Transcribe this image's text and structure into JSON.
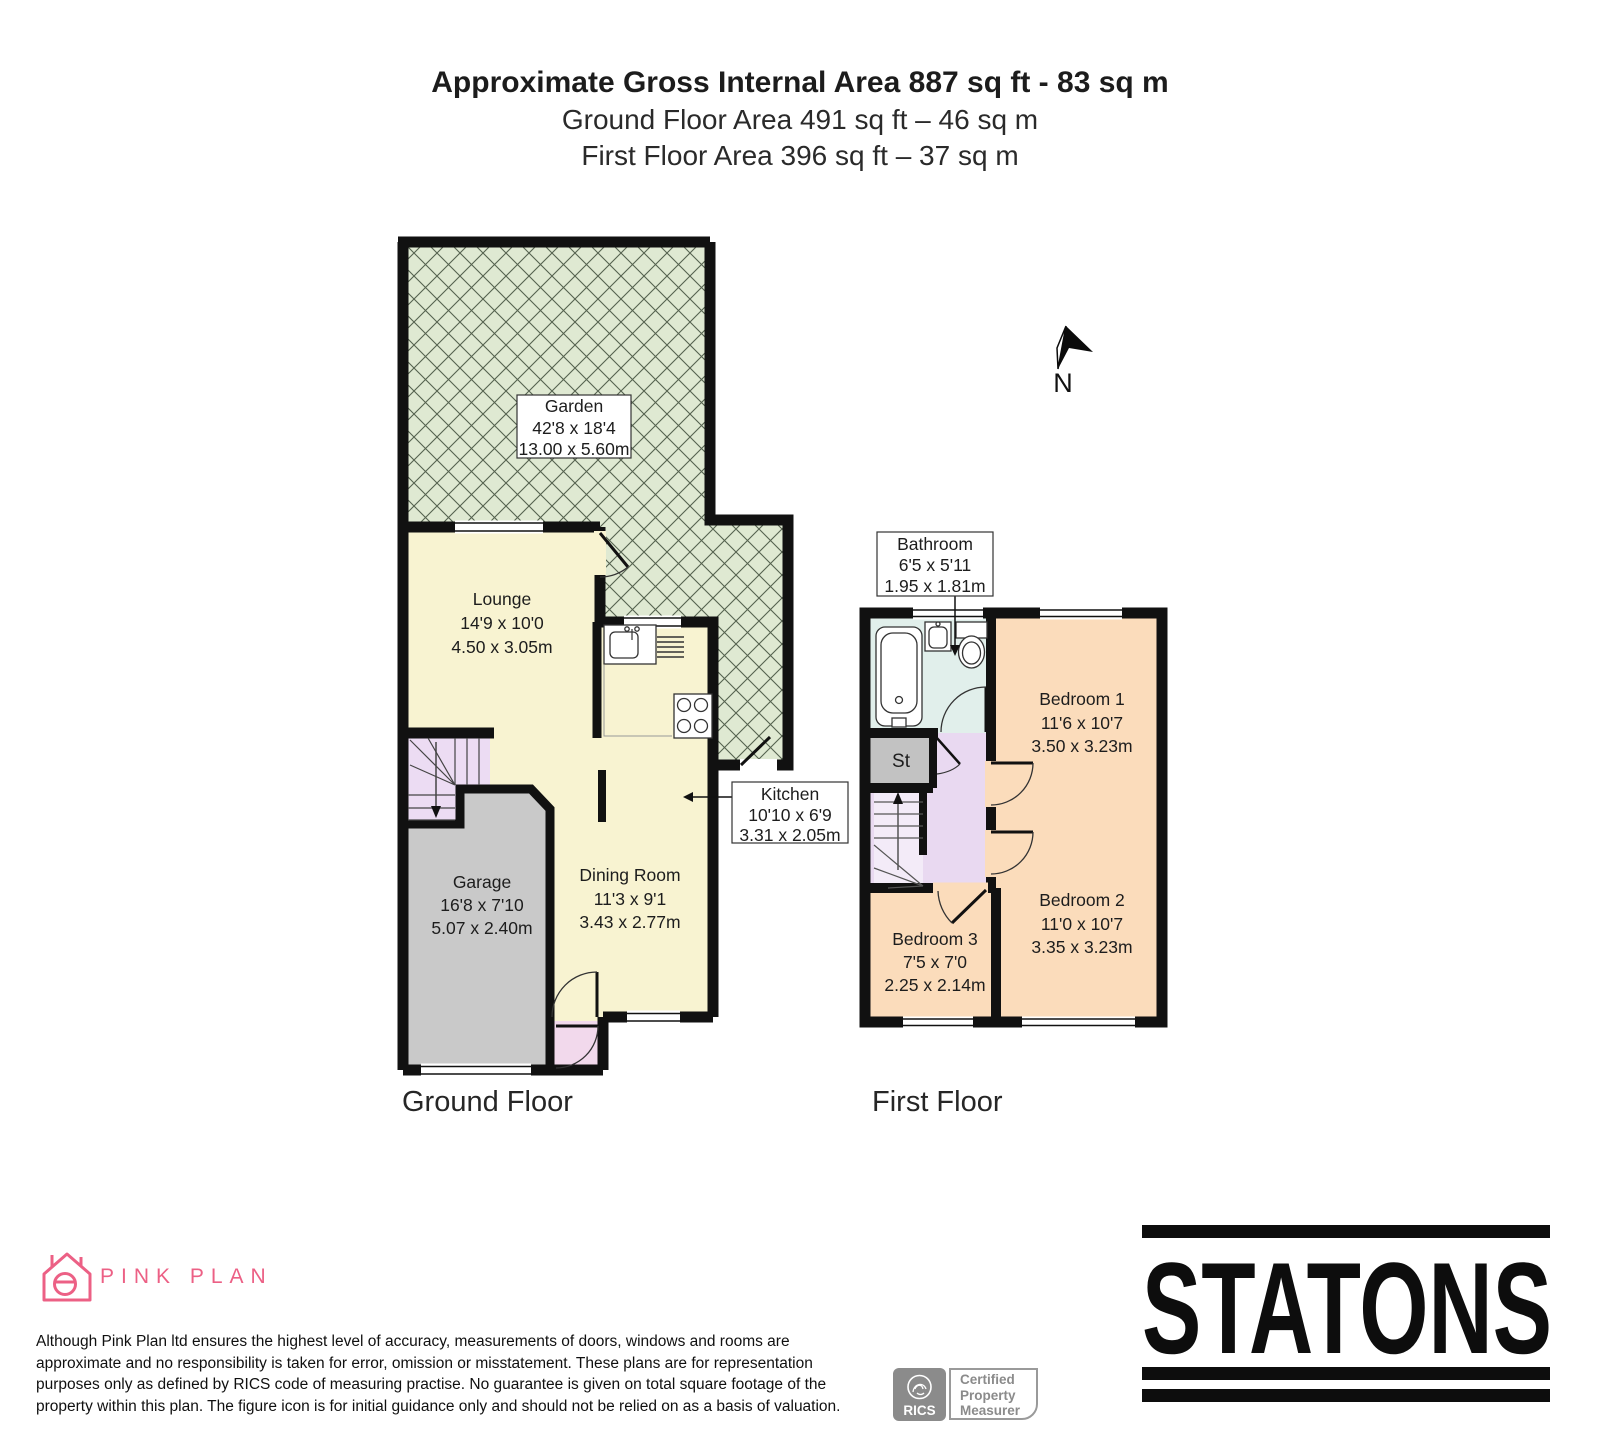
{
  "header": {
    "title": "Approximate Gross Internal Area 887 sq ft - 83 sq m",
    "ground_area": "Ground Floor Area 491 sq ft – 46 sq m",
    "first_area": "First Floor Area 396 sq ft – 37 sq m"
  },
  "rooms": {
    "garden": {
      "name": "Garden",
      "imperial": "42'8 x 18'4",
      "metric": "13.00 x 5.60m"
    },
    "lounge": {
      "name": "Lounge",
      "imperial": "14'9 x 10'0",
      "metric": "4.50 x 3.05m"
    },
    "kitchen": {
      "name": "Kitchen",
      "imperial": "10'10 x 6'9",
      "metric": "3.31 x 2.05m"
    },
    "dining_room": {
      "name": "Dining Room",
      "imperial": "11'3 x 9'1",
      "metric": "3.43 x 2.77m"
    },
    "garage": {
      "name": "Garage",
      "imperial": "16'8 x 7'10",
      "metric": "5.07 x 2.40m"
    },
    "bathroom": {
      "name": "Bathroom",
      "imperial": "6'5 x 5'11",
      "metric": "1.95 x 1.81m"
    },
    "bedroom1": {
      "name": "Bedroom 1",
      "imperial": "11'6 x 10'7",
      "metric": "3.50 x 3.23m"
    },
    "bedroom2": {
      "name": "Bedroom 2",
      "imperial": "11'0 x 10'7",
      "metric": "3.35 x 3.23m"
    },
    "bedroom3": {
      "name": "Bedroom 3",
      "imperial": "7'5 x 7'0",
      "metric": "2.25 x 2.14m"
    },
    "storage": {
      "name": "St"
    }
  },
  "floor_labels": {
    "ground": "Ground Floor",
    "first": "First Floor"
  },
  "compass": {
    "label": "N"
  },
  "branding": {
    "pink_plan": "PINK PLAN",
    "statons": "STATONS",
    "rics": {
      "name": "RICS",
      "lines": [
        "Certified",
        "Property",
        "Measurer"
      ]
    }
  },
  "disclaimer": {
    "lines": [
      "Although Pink Plan ltd ensures the highest level of accuracy, measurements of doors, windows and rooms are",
      "approximate and no responsibility is taken for error, omission or misstatement. These plans are for representation",
      "purposes only as defined by RICS code of measuring practise. No guarantee is given on total square footage of the",
      "property within this plan. The figure icon is for initial guidance only and should not be relied on as a basis of valuation."
    ]
  },
  "colors": {
    "wall": "#111111",
    "garden": "#dfe9d2",
    "room_cream": "#f8f3d1",
    "garage_gray": "#c9c9c9",
    "stairs_lilac": "#ecdcf3",
    "porch_pink": "#f2d9ec",
    "bedroom_peach": "#fbdcbb",
    "bathroom_blue": "#e1efeb",
    "landing_lilac": "#e9d9f1",
    "pink_plan": "#ec6085",
    "rics_gray": "#8b8b8b"
  }
}
